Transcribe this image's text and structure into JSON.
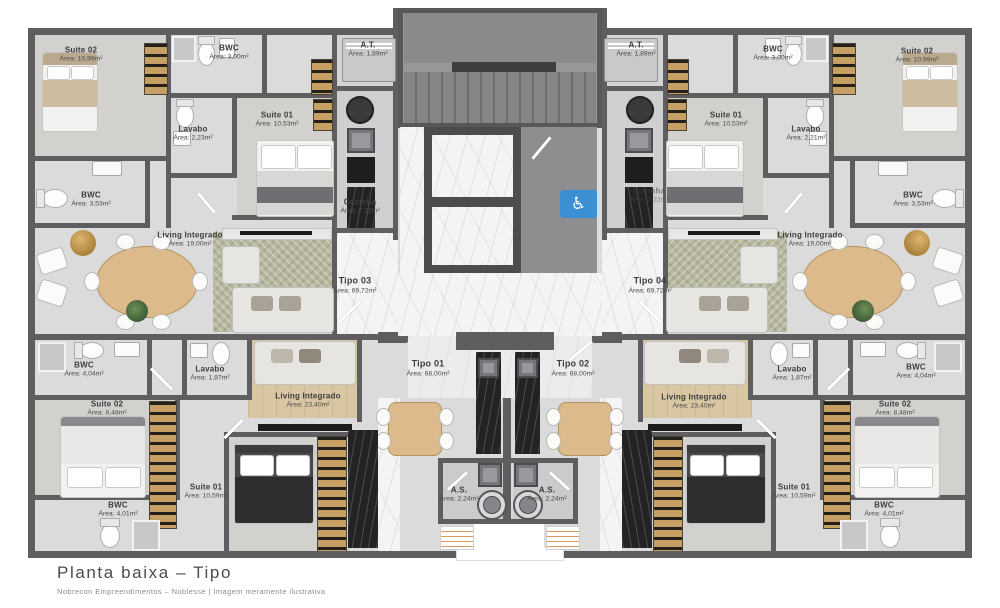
{
  "footer": {
    "title": "Planta baixa – Tipo",
    "subtitle": "Nobrecon Empreendimentos – Noblesse | Imagem meramente ilustrativa"
  },
  "units": {
    "tipo01": {
      "name": "Tipo 01",
      "area": "Área: 68,00m²"
    },
    "tipo02": {
      "name": "Tipo 02",
      "area": "Área: 68,00m²"
    },
    "tipo03": {
      "name": "Tipo 03",
      "area": "Área: 69,72m²"
    },
    "tipo04": {
      "name": "Tipo 04",
      "area": "Área: 69,72m²"
    }
  },
  "rooms": {
    "tl": {
      "suite02": {
        "name": "Suite 02",
        "area": "Área: 10,99m²"
      },
      "bwc_top": {
        "name": "BWC",
        "area": "Área: 3,00m²"
      },
      "lavabo": {
        "name": "Lavabo",
        "area": "Área: 2,23m²"
      },
      "suite01": {
        "name": "Suite 01",
        "area": "Área: 10,53m²"
      },
      "bwc": {
        "name": "BWC",
        "area": "Área: 3,53m²"
      },
      "cozinha": {
        "name": "Cozinha",
        "area": "Área: 7,22m²"
      },
      "at": {
        "name": "A.T.",
        "area": "Área: 1,89m²"
      },
      "living": {
        "name": "Living Integrado",
        "area": "Área: 19,00m²"
      }
    },
    "tr": {
      "suite02": {
        "name": "Suite 02",
        "area": "Área: 10,99m²"
      },
      "bwc_top": {
        "name": "BWC",
        "area": "Área: 3,00m²"
      },
      "lavabo": {
        "name": "Lavabo",
        "area": "Área: 2,21m²"
      },
      "suite01": {
        "name": "Suite 01",
        "area": "Área: 10,53m²"
      },
      "bwc": {
        "name": "BWC",
        "area": "Área: 3,53m²"
      },
      "cozinha": {
        "name": "Cozinha",
        "area": "Área: 7,22m²"
      },
      "at": {
        "name": "A.T.",
        "area": "Área: 1,89m²"
      },
      "living": {
        "name": "Living Integrado",
        "area": "Área: 19,00m²"
      }
    },
    "bl": {
      "bwc_top": {
        "name": "BWC",
        "area": "Área: 4,04m²"
      },
      "lavabo": {
        "name": "Lavabo",
        "area": "Área: 1,87m²"
      },
      "living": {
        "name": "Living Integrado",
        "area": "Área: 23,40m²"
      },
      "suite02": {
        "name": "Suite 02",
        "area": "Área: 8,48m²"
      },
      "suite01": {
        "name": "Suite 01",
        "area": "Área: 10,59m²"
      },
      "bwc_bottom": {
        "name": "BWC",
        "area": "Área: 4,01m²"
      },
      "as": {
        "name": "A.S.",
        "area": "Área: 2,24m²"
      }
    },
    "br": {
      "bwc_top": {
        "name": "BWC",
        "area": "Área: 4,04m²"
      },
      "lavabo": {
        "name": "Lavabo",
        "area": "Área: 1,87m²"
      },
      "living": {
        "name": "Living Integrado",
        "area": "Área: 23,40m²"
      },
      "suite02": {
        "name": "Suite 02",
        "area": "Área: 8,48m²"
      },
      "suite01": {
        "name": "Suite 01",
        "area": "Área: 10,59m²"
      },
      "bwc_bottom": {
        "name": "BWC",
        "area": "Área: 4,01m²"
      },
      "as": {
        "name": "A.S.",
        "area": "Área: 2,24m²"
      }
    }
  },
  "icons": {
    "accessibility_glyph": "♿"
  },
  "colors": {
    "accent_blue": "#3d8fd3",
    "wall_gray": "#5e5e61"
  }
}
